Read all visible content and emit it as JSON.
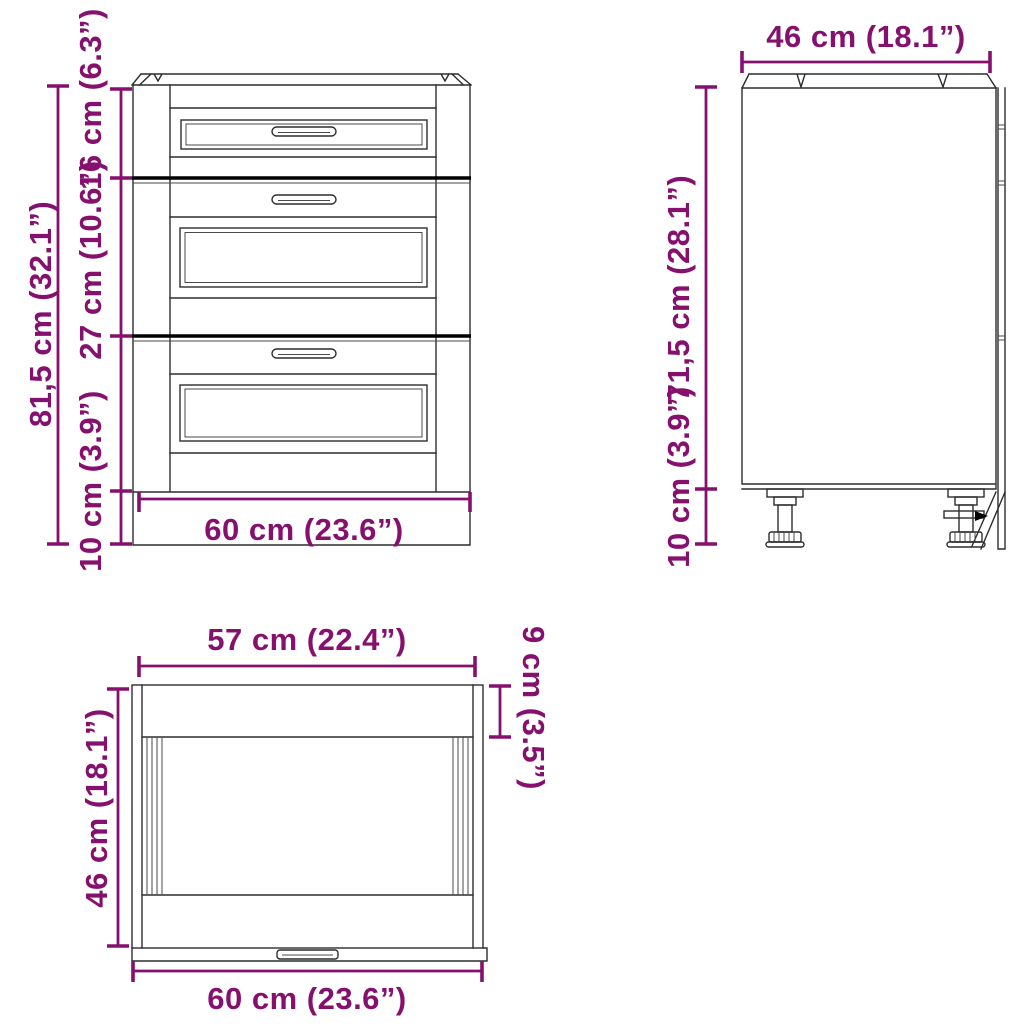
{
  "diagram_title": "Cabinet dimension diagram",
  "colors": {
    "dimension": "#86106e",
    "outline": "#2d2d2d",
    "separator": "#000000",
    "background": "#ffffff"
  },
  "front_view": {
    "labels": {
      "total_height": "81,5 cm (32.1”)",
      "top_drawer_height": "16 cm (6.3”)",
      "middle_drawer_height": "27 cm (10.6”)",
      "plinth_height": "10 cm (3.9”)",
      "width": "60 cm (23.6”)"
    }
  },
  "side_view": {
    "labels": {
      "depth": "46 cm (18.1”)",
      "body_height": "71,5 cm (28.1”)",
      "leg_height": "10 cm (3.9”)"
    }
  },
  "top_view": {
    "labels": {
      "inner_width": "57 cm (22.4”)",
      "front_panel_depth": "9 cm (3.5”)",
      "depth": "46 cm (18.1”)",
      "width": "60 cm (23.6”)"
    }
  }
}
